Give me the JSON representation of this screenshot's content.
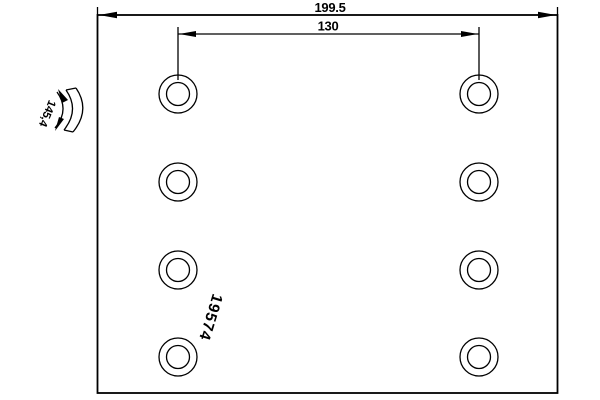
{
  "drawing": {
    "title": "brake-lining-technical-drawing",
    "part_number": "19574",
    "dimensions": {
      "overall_width": "199.5",
      "hole_spacing": "130",
      "arc_length": "145,4"
    },
    "holes": {
      "count": 8,
      "columns": 2,
      "rows": 4
    },
    "colors": {
      "line": "#000000",
      "background": "#ffffff"
    }
  }
}
